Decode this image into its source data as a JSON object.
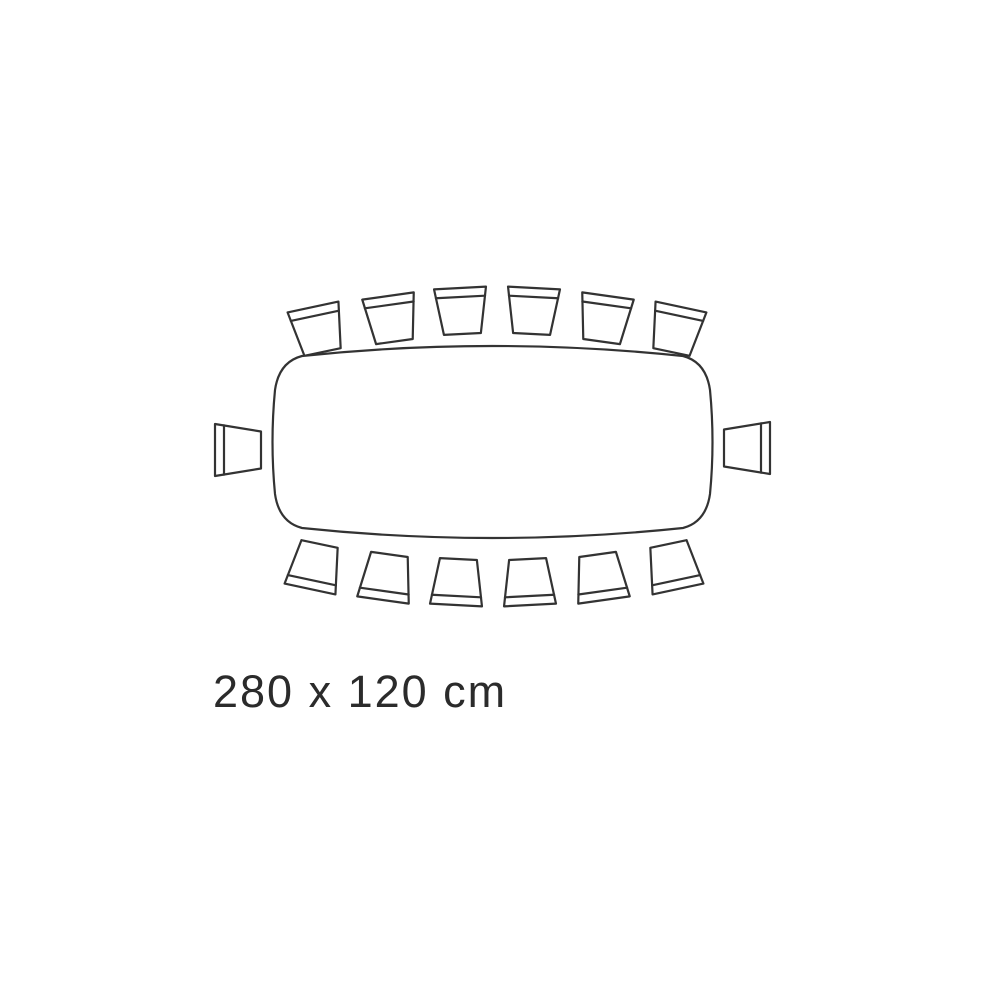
{
  "diagram": {
    "type": "table-seating-plan-top-view",
    "table": {
      "shape": "rounded-rectangle-barrel-edges",
      "dimensions_label": "280 x 120 cm"
    },
    "seats": {
      "total": 14,
      "top_row": 6,
      "bottom_row": 6,
      "left_end": 1,
      "right_end": 1
    },
    "colors": {
      "line": "#333333",
      "text": "#2b2b2b",
      "fill": "#ffffff",
      "background": "#ffffff"
    }
  }
}
